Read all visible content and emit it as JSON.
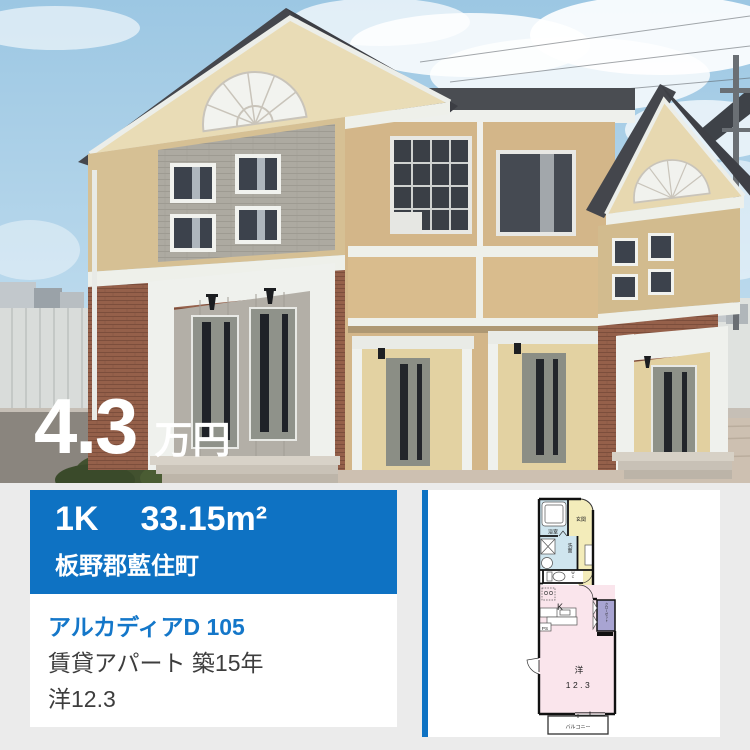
{
  "price": {
    "value": "4.3",
    "unit": "万円"
  },
  "summary": {
    "layout": "1K",
    "area": "33.15m²",
    "location": "板野郡藍住町"
  },
  "details": {
    "name": "アルカディアD 105",
    "type_age": "賃貸アパート 築15年",
    "rooms": "洋12.3"
  },
  "floorplan": {
    "labels": {
      "bath": "浴室",
      "entrance": "玄関",
      "washroom": "洗面",
      "wc": "WC",
      "kitchen": "K",
      "ps": "PS",
      "closet": "クローゼット",
      "room_type": "洋",
      "room_size": "12.3",
      "balcony": "バルコニー"
    }
  },
  "colors": {
    "accent_blue": "#0e72c3",
    "link_blue": "#1477c9",
    "page_background": "#ebebeb",
    "price_text": "#ffffff",
    "floorplan_bath": "#cfe5ee",
    "floorplan_entrance": "#f3ecba",
    "floorplan_room": "#fae5ec",
    "floorplan_closet": "#a8a4d2"
  }
}
